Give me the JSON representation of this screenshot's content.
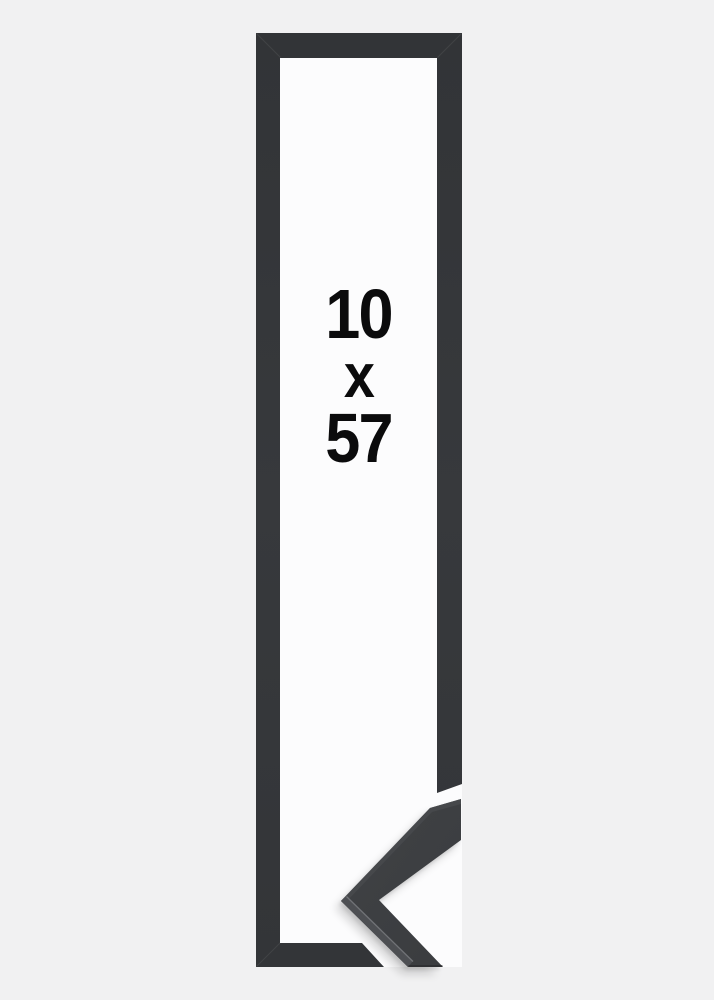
{
  "product_image": {
    "description": "Tall narrow black picture frame shown flat with a mitered corner profile sample overlapping the bottom-right corner",
    "size_label": {
      "width_value": "10",
      "separator": "x",
      "height_value": "57"
    },
    "colors": {
      "page_background": "#f1f1f2",
      "mat_white": "#fcfcfd",
      "frame_dark": "#343639",
      "sample_face": "#3d3f42",
      "sample_bevel_light": "#4d4f53",
      "sample_edge_highlight": "#787a7e",
      "label_text": "#0b0b0c"
    }
  }
}
